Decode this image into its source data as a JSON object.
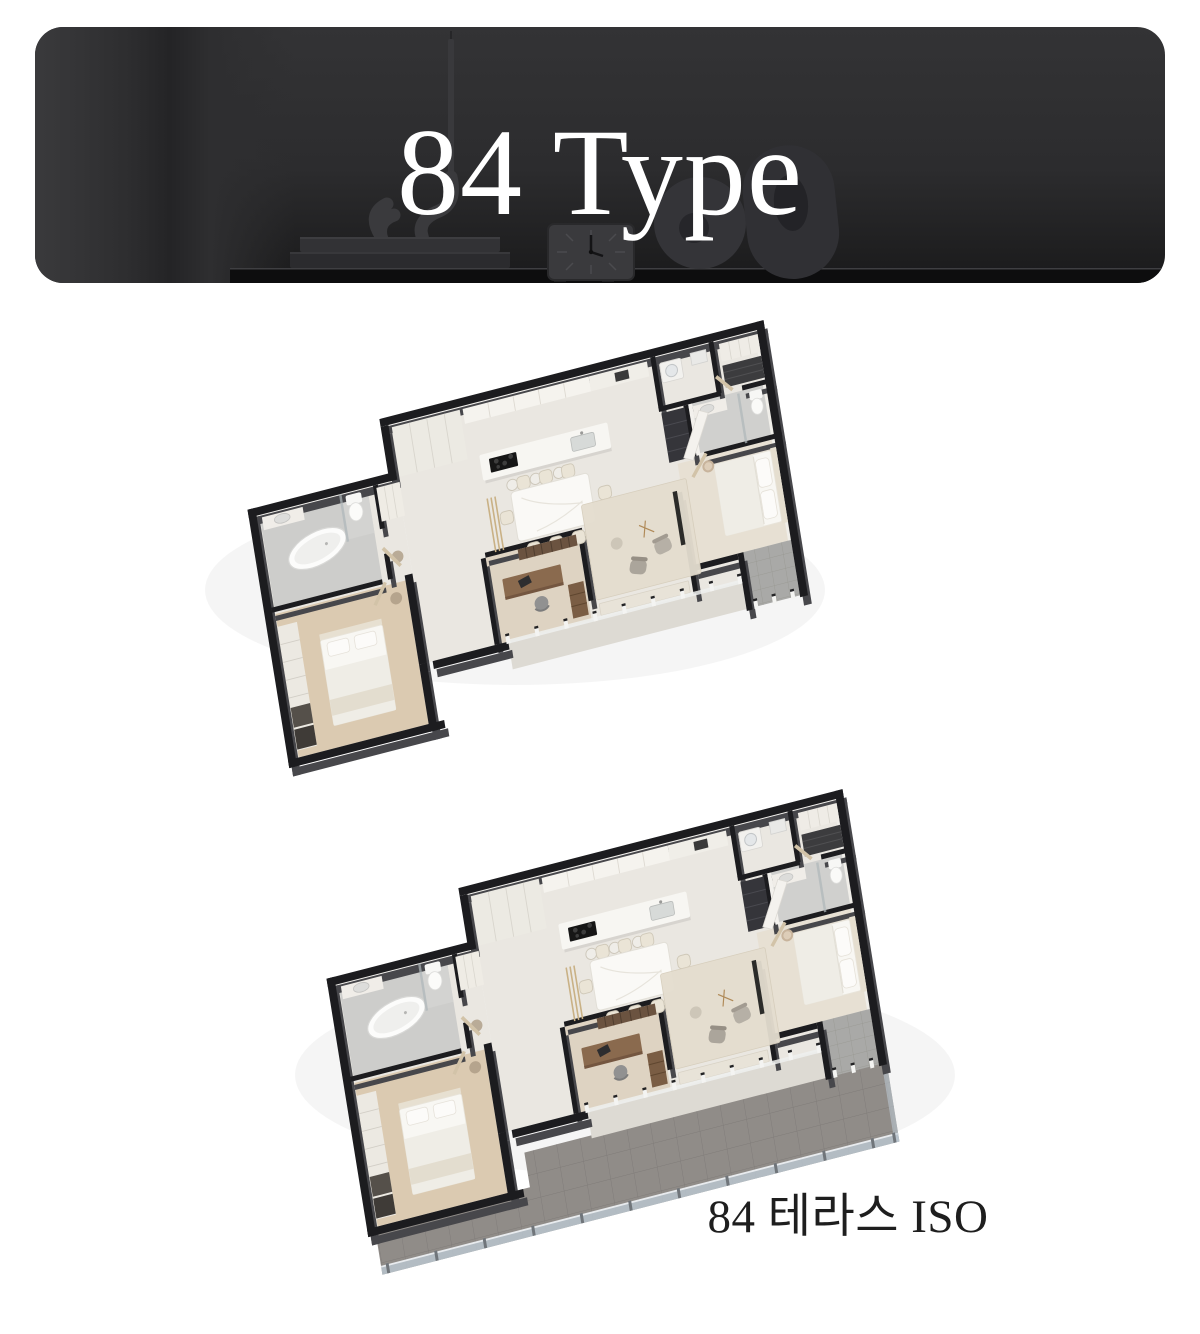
{
  "header": {
    "title": "84 Type",
    "title_color": "#ffffff",
    "background": "#2c2c2e",
    "decor_items": [
      "candle-stick",
      "wave-candle-holder",
      "stacked-books",
      "square-desk-clock",
      "donut-sculpture",
      "arch-sculpture",
      "console-table"
    ]
  },
  "plans": {
    "terrace_caption": "84 테라스 ISO",
    "caption_color": "#1e1e1e"
  },
  "palette": {
    "wall_top": "#1c1c1f",
    "wall_side": "#47474b",
    "floor_main": "#eae7e1",
    "floor_wood": "#dbcab1",
    "floor_bath_tile": "#cdcdcb",
    "terrace_tile": "#908c88",
    "railing_glass": "#bcc8d2",
    "furniture_wood": "#8a6a4e",
    "bedding_white": "#f8f7f3",
    "marble_table": "#faf9f6"
  }
}
